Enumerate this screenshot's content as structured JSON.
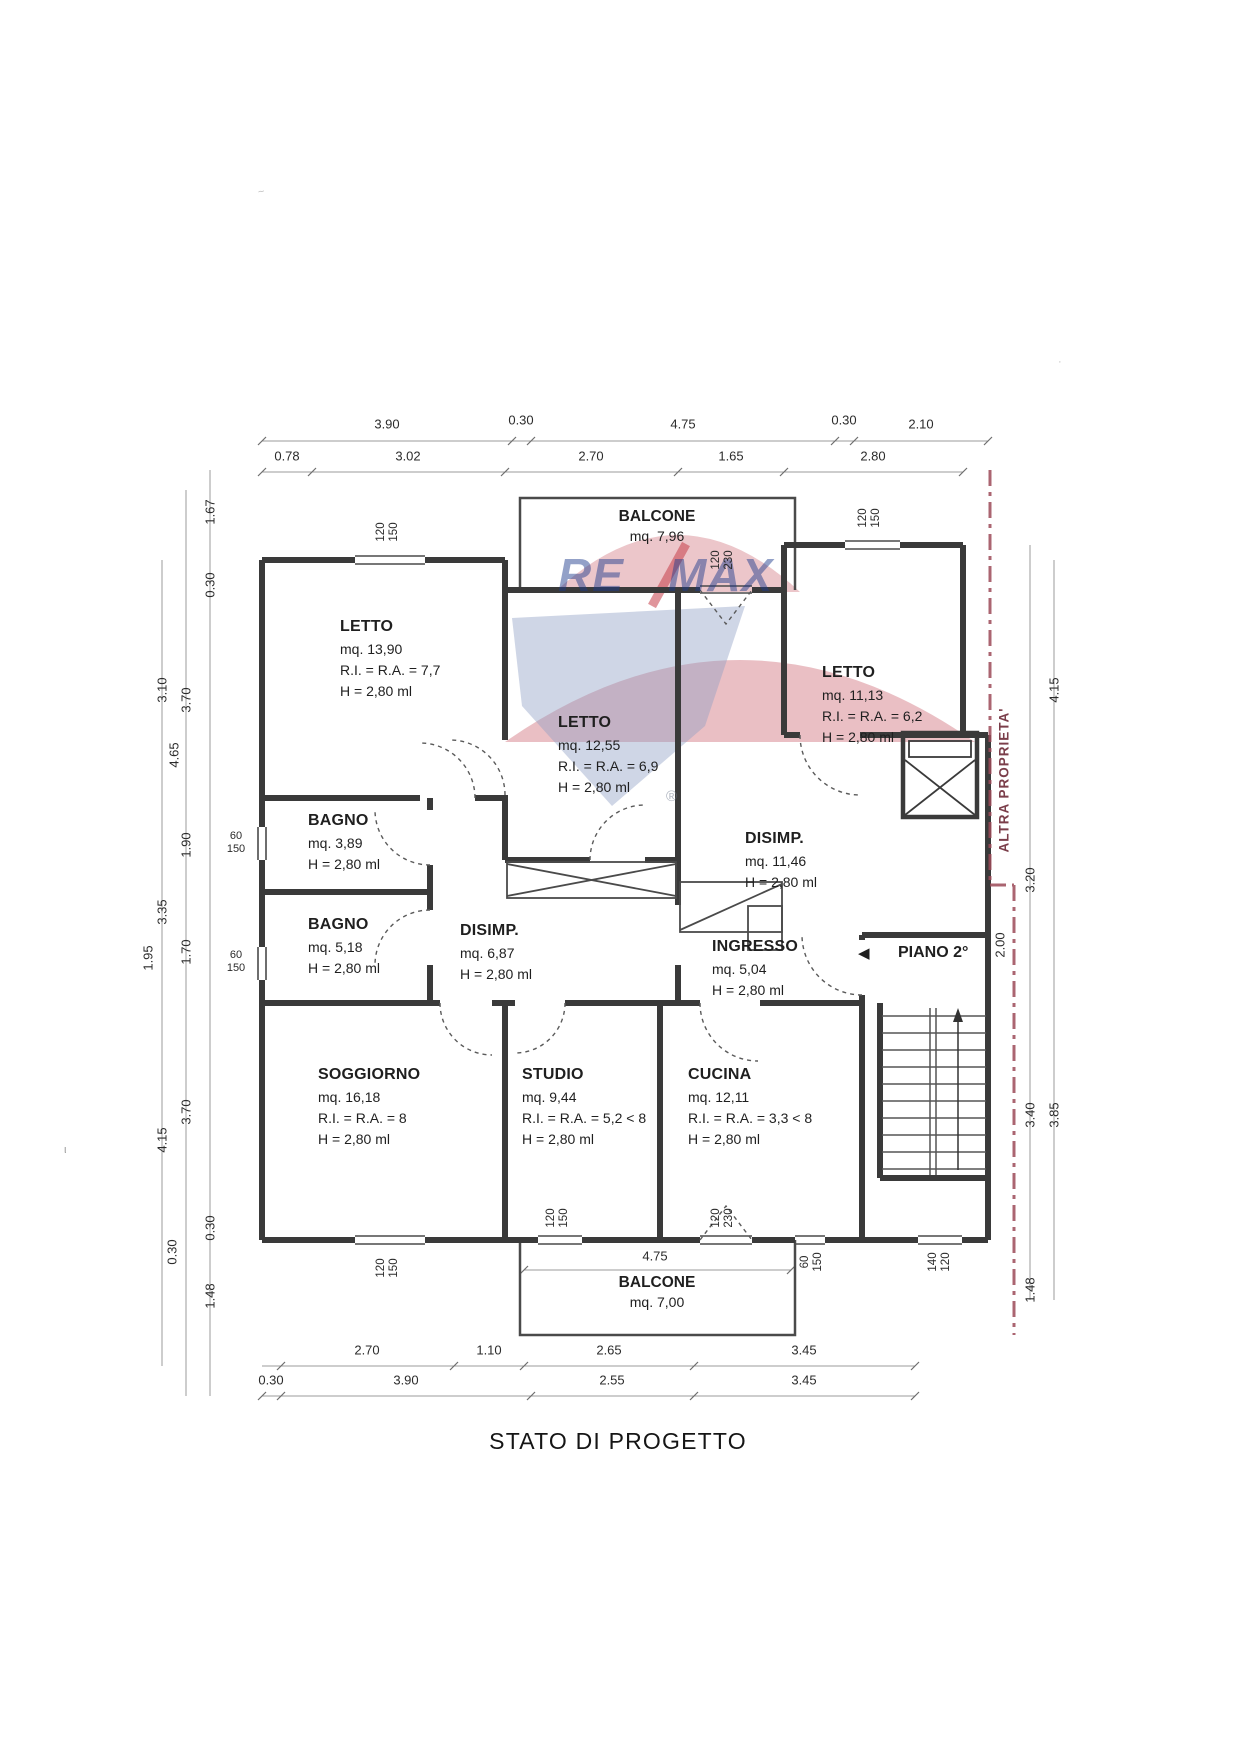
{
  "page": {
    "title": "STATO DI PROGETTO"
  },
  "watermark": {
    "re": "RE",
    "max": "MAX",
    "registered": "®"
  },
  "plan": {
    "piano_label": "PIANO 2°",
    "boundary_label": "ALTRA PROPRIETA'",
    "door_arrow": "◀"
  },
  "rooms": [
    {
      "id": "letto-1",
      "name": "LETTO",
      "area": "mq. 13,90",
      "ratio": "R.I. = R.A. = 7,7",
      "height": "H = 2,80 ml"
    },
    {
      "id": "letto-2",
      "name": "LETTO",
      "area": "mq. 12,55",
      "ratio": "R.I. = R.A. = 6,9",
      "height": "H = 2,80 ml"
    },
    {
      "id": "letto-3",
      "name": "LETTO",
      "area": "mq. 11,13",
      "ratio": "R.I. = R.A. = 6,2",
      "height": "H = 2,80 ml"
    },
    {
      "id": "bagno-1",
      "name": "BAGNO",
      "area": "mq. 3,89",
      "height": "H = 2,80 ml"
    },
    {
      "id": "bagno-2",
      "name": "BAGNO",
      "area": "mq. 5,18",
      "height": "H = 2,80 ml"
    },
    {
      "id": "disimp-1",
      "name": "DISIMP.",
      "area": "mq. 6,87",
      "height": "H = 2,80 ml"
    },
    {
      "id": "disimp-2",
      "name": "DISIMP.",
      "area": "mq. 11,46",
      "height": "H = 2,80 ml"
    },
    {
      "id": "ingresso",
      "name": "INGRESSO",
      "area": "mq. 5,04",
      "height": "H = 2,80 ml"
    },
    {
      "id": "soggiorno",
      "name": "SOGGIORNO",
      "area": "mq. 16,18",
      "ratio": "R.I. = R.A. = 8",
      "height": "H = 2,80 ml"
    },
    {
      "id": "studio",
      "name": "STUDIO",
      "area": "mq. 9,44",
      "ratio": "R.I. = R.A. = 5,2 < 8",
      "height": "H = 2,80 ml"
    },
    {
      "id": "cucina",
      "name": "CUCINA",
      "area": "mq. 12,11",
      "ratio": "R.I. = R.A. = 3,3 < 8",
      "height": "H = 2,80 ml"
    },
    {
      "id": "balcone-top",
      "name": "BALCONE",
      "area": "mq. 7,96"
    },
    {
      "id": "balcone-bottom",
      "name": "BALCONE",
      "area": "mq. 7,00"
    }
  ],
  "dims": {
    "top_row1": [
      "3.90",
      "0.30",
      "4.75",
      "0.30",
      "2.10"
    ],
    "top_row2": [
      "0.78",
      "3.02",
      "2.70",
      "1.65",
      "2.80"
    ],
    "bottom_row1": [
      "2.70",
      "1.10",
      "2.65",
      "3.45"
    ],
    "bottom_row2": [
      "0.30",
      "3.90",
      "2.55",
      "3.45"
    ],
    "left": [
      "1.67",
      "0.30",
      "3.10",
      "3.70",
      "4.65",
      "1.90",
      "3.35",
      "1.95",
      "1.70",
      "3.70",
      "4.15",
      "0.30",
      "0.30",
      "1.48"
    ],
    "right": [
      "4.15",
      "3.20",
      "2.00",
      "3.40",
      "3.85",
      "1.48"
    ],
    "balcone_inner": "4.75",
    "windows": [
      [
        "120",
        "150"
      ],
      [
        "120",
        "230"
      ],
      [
        "120",
        "150"
      ],
      [
        "60",
        "150"
      ],
      [
        "60",
        "150"
      ],
      [
        "120",
        "150"
      ],
      [
        "120",
        "150"
      ],
      [
        "120",
        "230"
      ],
      [
        "60",
        "150"
      ],
      [
        "140",
        "120"
      ]
    ]
  }
}
